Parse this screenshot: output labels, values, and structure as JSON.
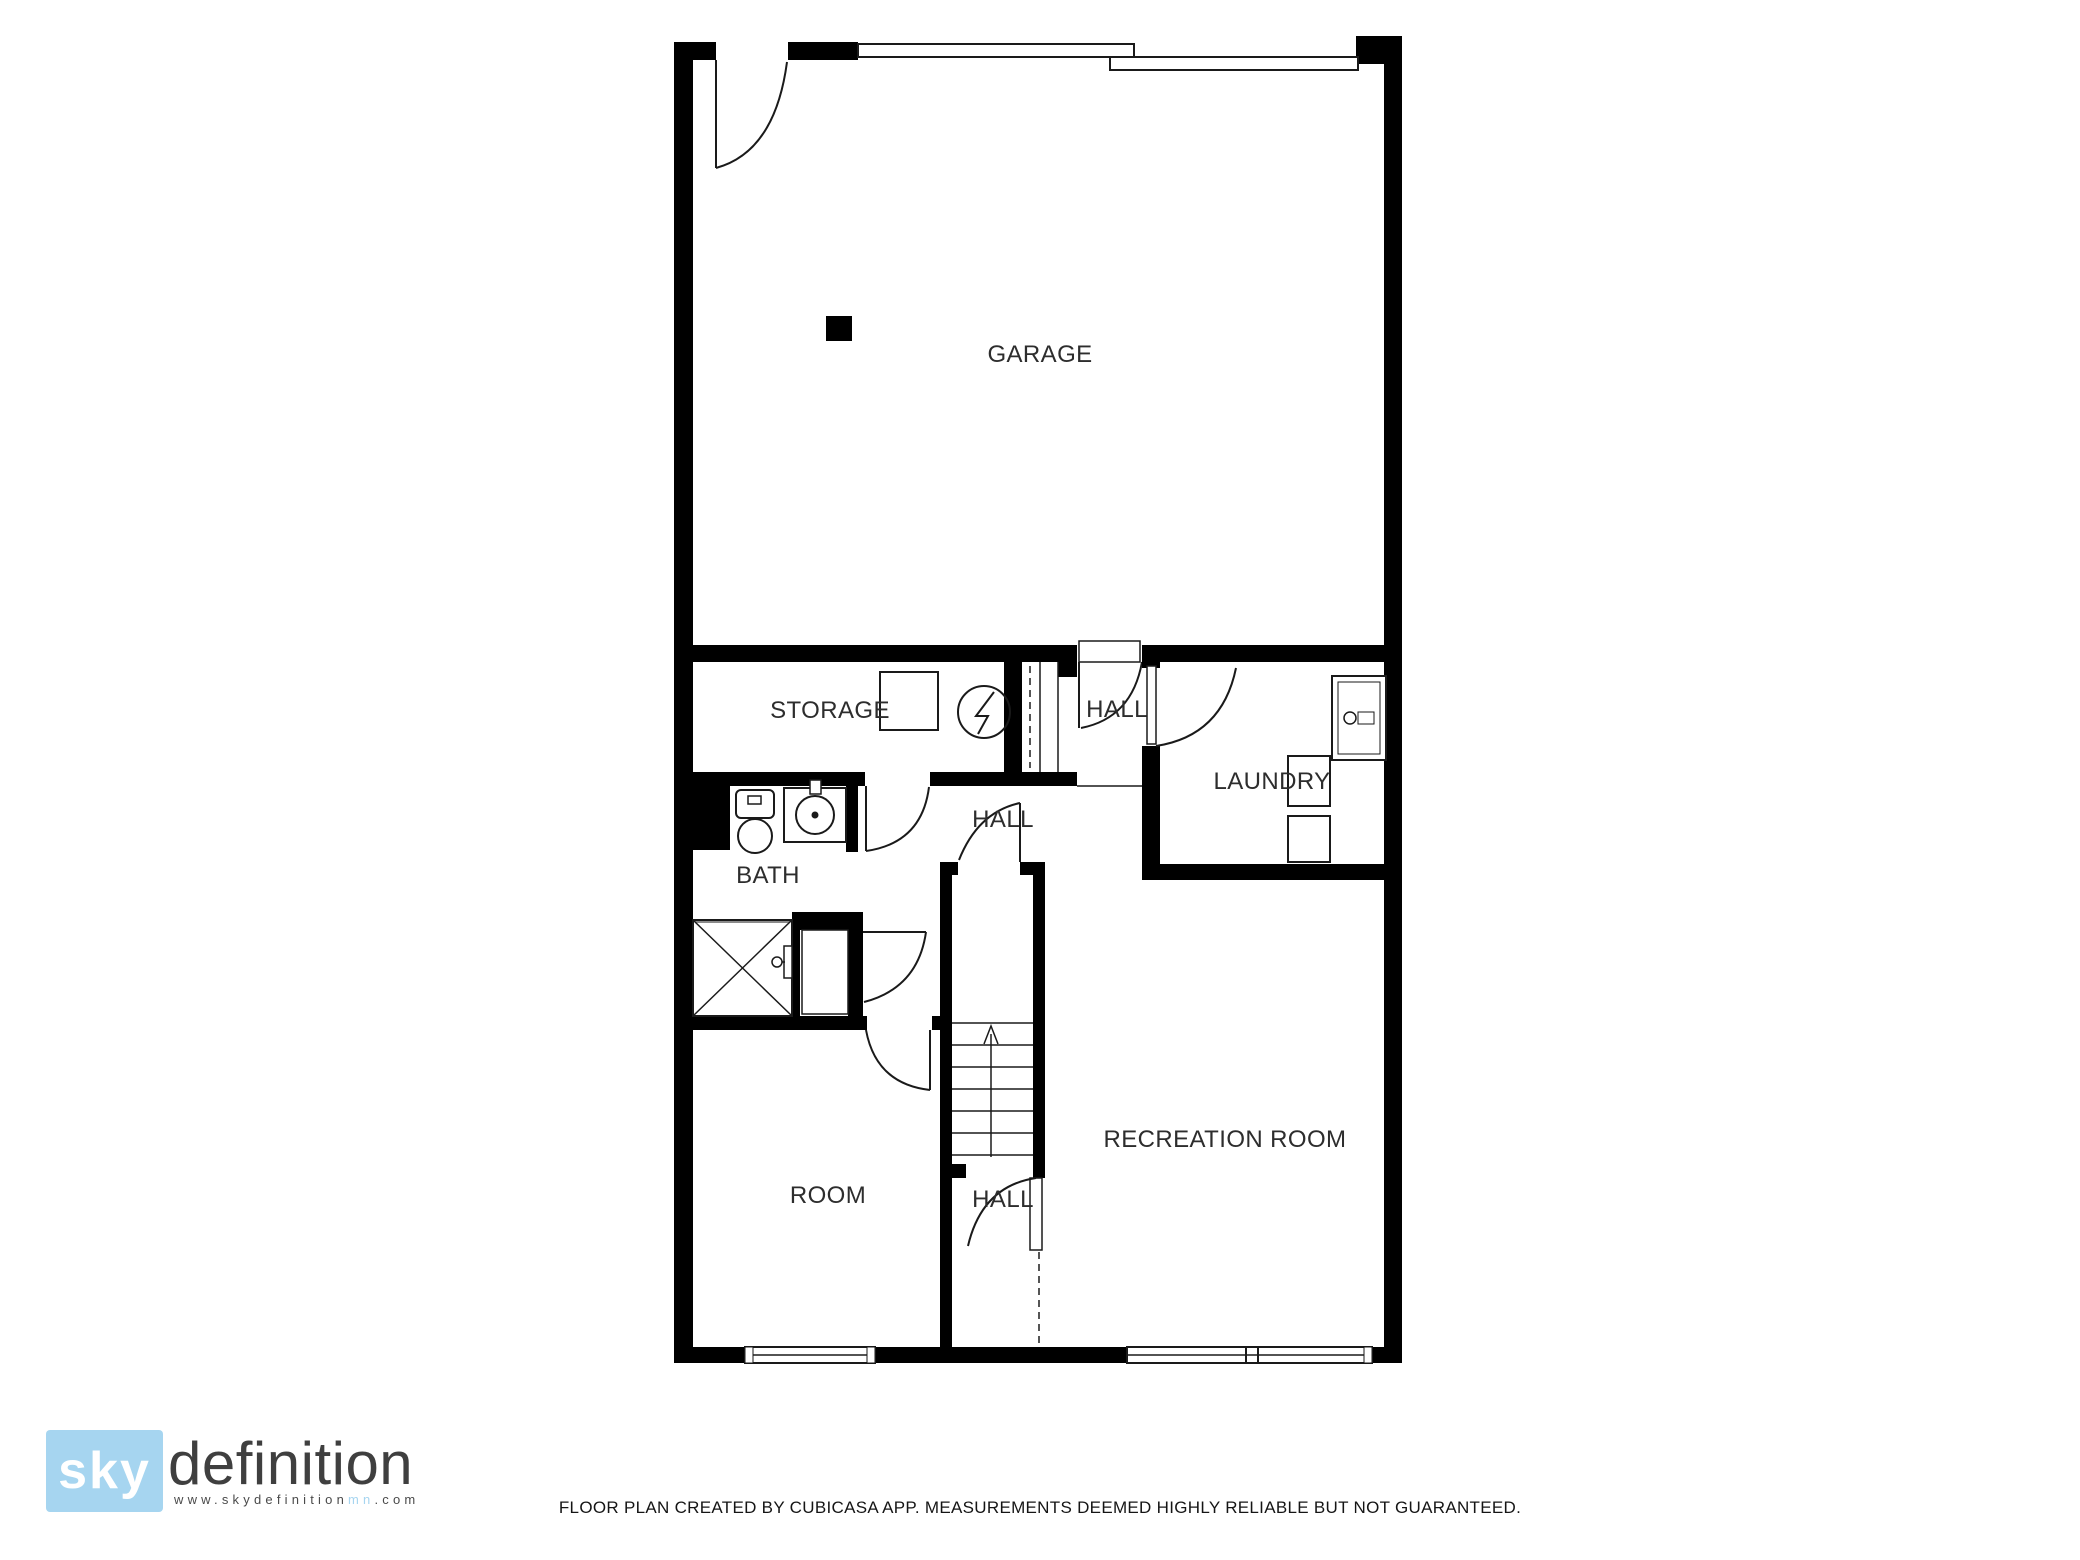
{
  "rooms": {
    "garage": {
      "label": "GARAGE"
    },
    "storage": {
      "label": "STORAGE"
    },
    "hall_upper": {
      "label": "HALL"
    },
    "laundry": {
      "label": "LAUNDRY"
    },
    "bath": {
      "label": "BATH"
    },
    "hall_landing": {
      "label": "HALL"
    },
    "room": {
      "label": "ROOM"
    },
    "hall_lower": {
      "label": "HALL"
    },
    "recreation": {
      "label": "RECREATION ROOM"
    }
  },
  "symbols": {
    "entry_door": "quarter-arc-door",
    "garage_door": "double-line-sliding-panels",
    "water_heater": "circle-with-lightning",
    "storage_box": "square-outline",
    "washer": "appliance-with-dial",
    "laundry_units": "two-stacked-squares",
    "toilet": "tank-and-bowl",
    "sink": "square-with-basin-circle",
    "shower": "crossed-box-with-faucet",
    "stairs": "treads-with-up-arrow",
    "windows": "triple-line-frames"
  },
  "logo": {
    "sky": "sky",
    "definition": "definition",
    "url_prefix": "www.skydefinition",
    "url_mn": "mn",
    "url_suffix": ".com"
  },
  "footer": {
    "disclaimer": "FLOOR PLAN CREATED BY CUBICASA APP. MEASUREMENTS DEEMED HIGHLY RELIABLE BUT NOT GUARANTEED."
  },
  "colors": {
    "wall": "#000000",
    "thin_line": "#1a1a1a",
    "label_text": "#2d2d2d",
    "logo_blue": "#a6d5f0"
  }
}
